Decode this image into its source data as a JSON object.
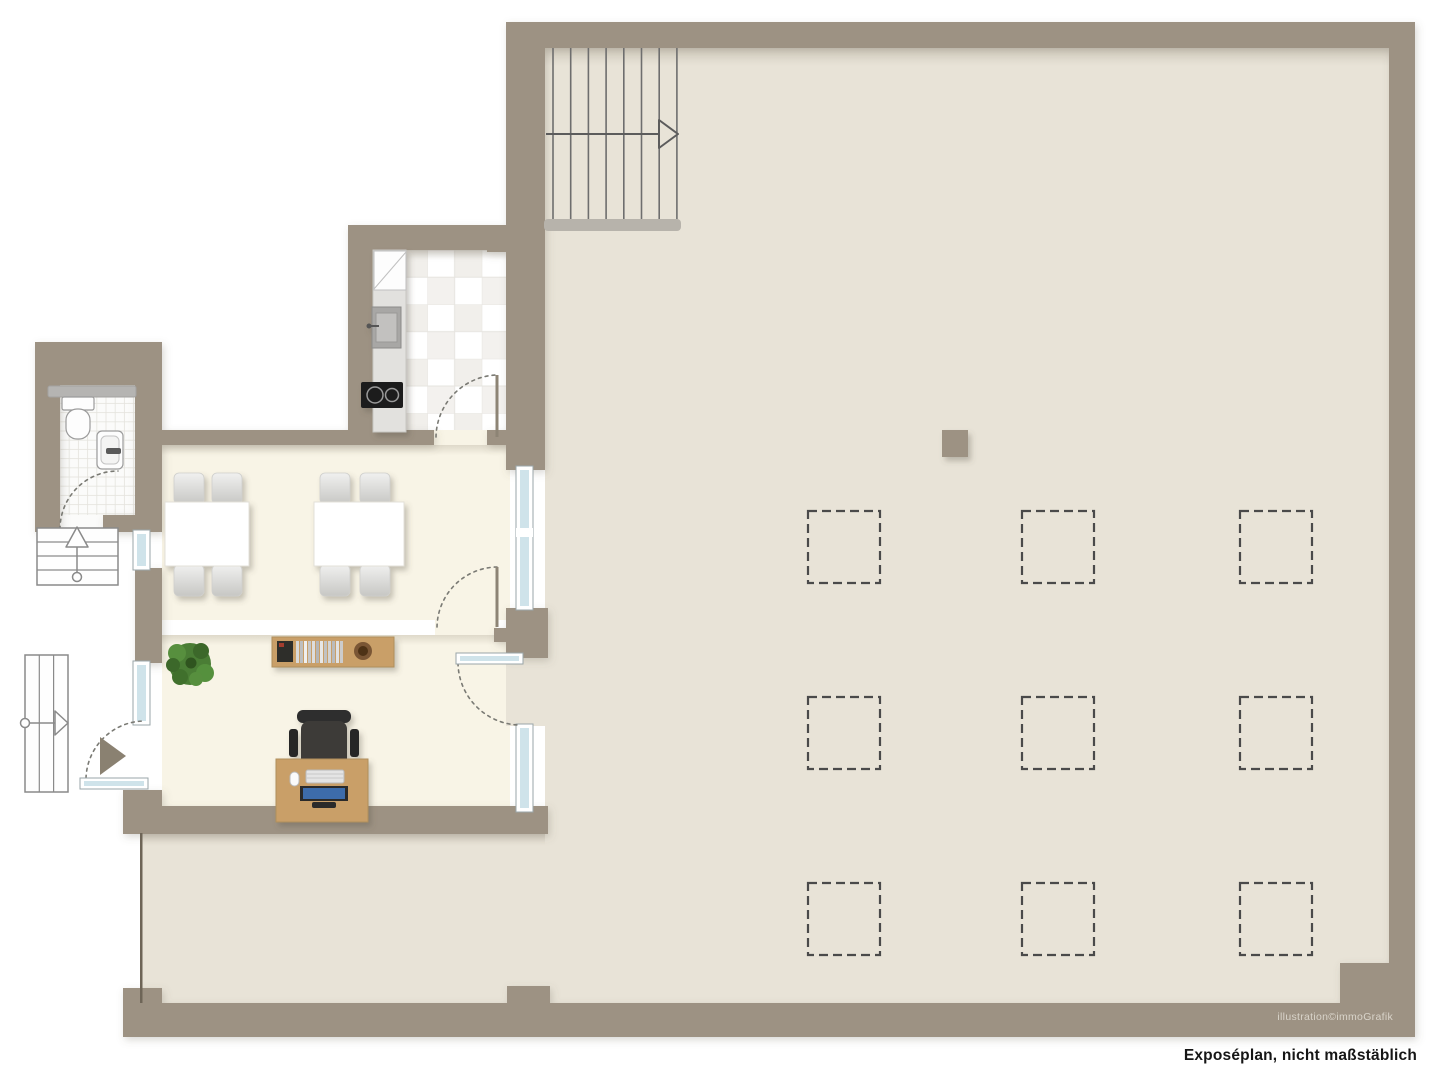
{
  "captions": {
    "watermark": "illustration©immoGrafik",
    "disclaimer": "Exposéplan, nicht maßstäblich"
  },
  "palette": {
    "wall": "#9d9283",
    "floor_main": "#e8e3d7",
    "floor_rooms": "#f8f4e6",
    "window_glass": "#cfe3ea",
    "wood": "#c99f68",
    "plant_green": "#4a7d35",
    "stair_line": "#8a8a8a",
    "dashed_marker": "#4a4a4a",
    "monitor_screen": "#3e6cab",
    "door_leaf": "#8d8475",
    "entrance_arrow": "#8a8171",
    "watermark_text": "#d9d4ca",
    "disclaimer_text": "#161616"
  },
  "plan": {
    "dashed_markers": {
      "rows": 3,
      "cols": 3,
      "count": 9
    },
    "staircases": {
      "hall_top": {
        "steps": 8,
        "direction": "right"
      },
      "side_entry": {
        "steps": 4,
        "direction": "up"
      },
      "main_entry": {
        "steps": 3,
        "direction": "right"
      }
    },
    "furniture": [
      "dining-table x2",
      "chair x8",
      "kitchen-counter",
      "refrigerator",
      "kitchen-sink",
      "cooktop",
      "toilet",
      "washbasin",
      "shower-tray",
      "plant",
      "sideboard",
      "desk",
      "office-chair",
      "monitor",
      "keyboard",
      "mouse",
      "pillar"
    ]
  }
}
